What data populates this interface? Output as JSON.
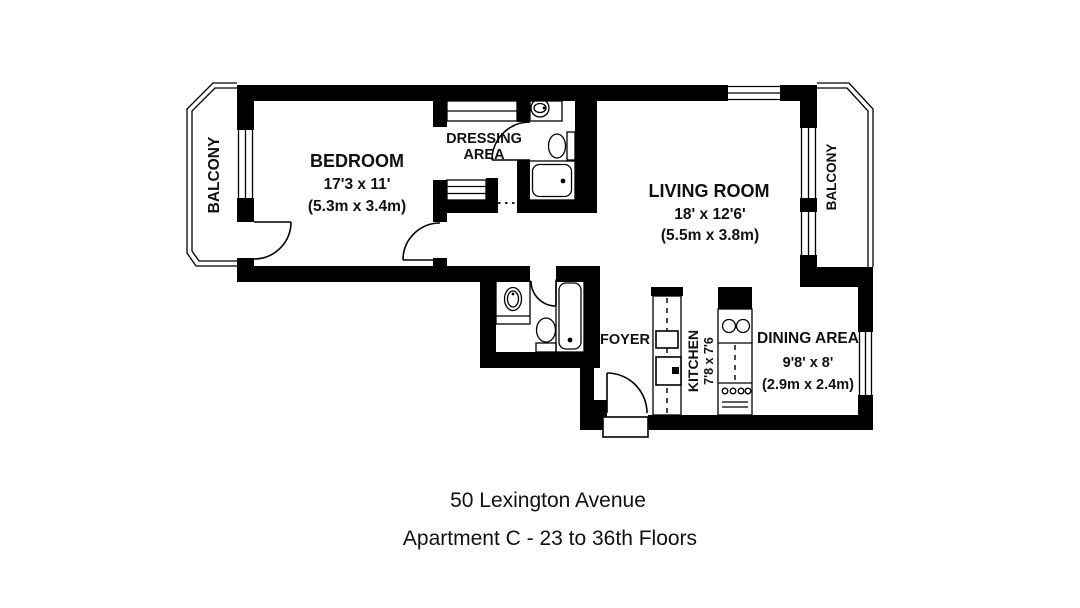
{
  "floorplan": {
    "bedroom": {
      "name": "BEDROOM",
      "dim_ft": "17'3 x 11'",
      "dim_m": "(5.3m x 3.4m)"
    },
    "dressing_area": {
      "line1": "DRESSING",
      "line2": "AREA"
    },
    "living_room": {
      "name": "LIVING ROOM",
      "dim_ft": "18' x 12'6'",
      "dim_m": "(5.5m x 3.8m)"
    },
    "foyer": {
      "name": "FOYER"
    },
    "kitchen": {
      "name": "KITCHEN",
      "dim_ft": "7'8 x 7'6"
    },
    "dining_area": {
      "name": "DINING AREA",
      "dim_ft": "9'8' x 8'",
      "dim_m": "(2.9m x 2.4m)"
    },
    "balcony_left": {
      "name": "BALCONY"
    },
    "balcony_right": {
      "name": "BALCONY"
    },
    "colors": {
      "wall": "#000000",
      "background": "#ffffff"
    }
  },
  "footer": {
    "address": "50 Lexington Avenue",
    "unit": "Apartment C - 23 to 36th Floors"
  }
}
